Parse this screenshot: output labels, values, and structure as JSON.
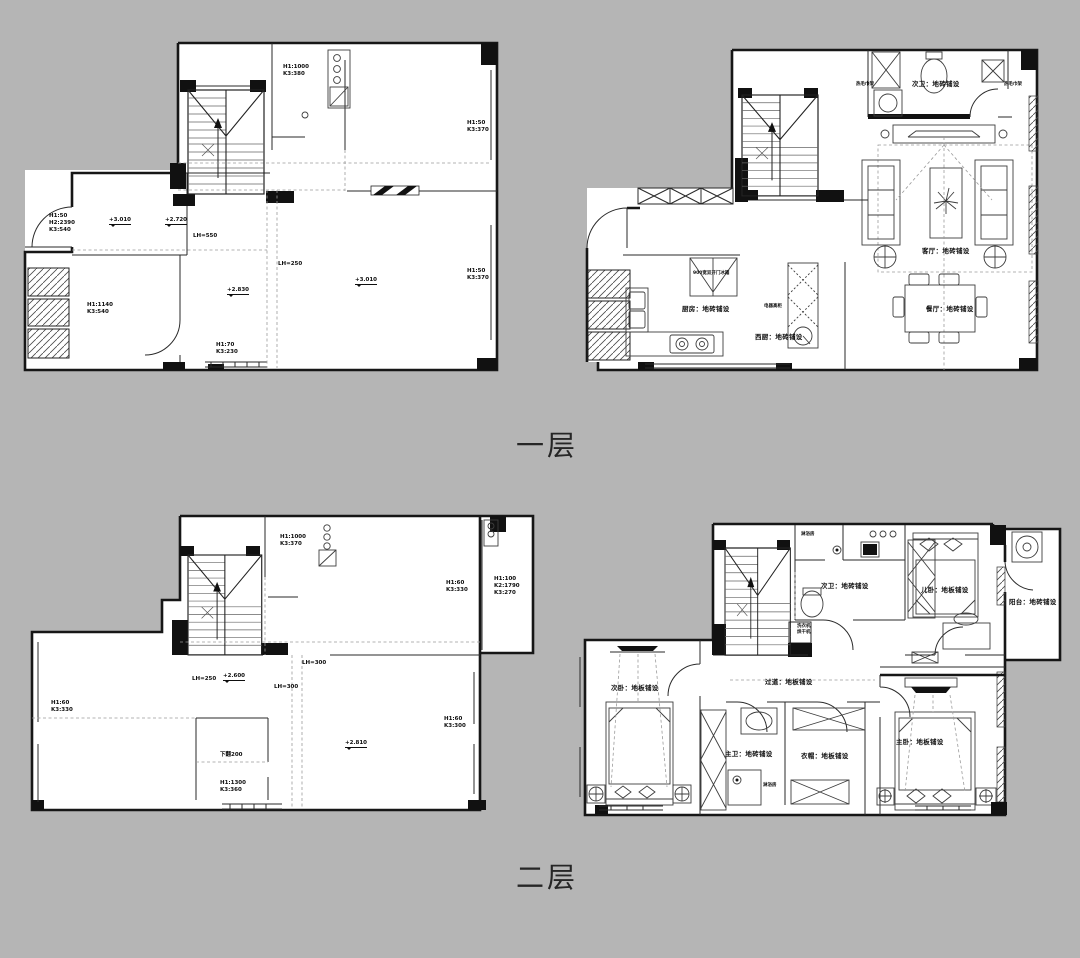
{
  "page": {
    "background": "#b5b5b5",
    "line_color": "#161616",
    "paper_color": "#ffffff"
  },
  "captions": {
    "floor1": "一层",
    "floor2": "二层"
  },
  "floor1_structural": {
    "annotations": [
      {
        "text": "H1:1000\nK3:380",
        "x": 268,
        "y": 54,
        "cls": "dim"
      },
      {
        "text": "H1:50\nK3:370",
        "x": 452,
        "y": 110,
        "cls": "dim"
      },
      {
        "text": "+3.010",
        "x": 94,
        "y": 207,
        "cls": "elev"
      },
      {
        "text": "+2.720",
        "x": 150,
        "y": 207,
        "cls": "elev"
      },
      {
        "text": "LH=550",
        "x": 178,
        "y": 223,
        "cls": "dim"
      },
      {
        "text": "H1:50\nH2:2390\nK3:540",
        "x": 34,
        "y": 203,
        "cls": "dim"
      },
      {
        "text": "LH=250",
        "x": 263,
        "y": 251,
        "cls": "dim"
      },
      {
        "text": "+3.010",
        "x": 340,
        "y": 267,
        "cls": "elev"
      },
      {
        "text": "H1:50\nK3:370",
        "x": 452,
        "y": 258,
        "cls": "dim"
      },
      {
        "text": "+2.830",
        "x": 212,
        "y": 277,
        "cls": "elev"
      },
      {
        "text": "H1:1140\nK3:540",
        "x": 72,
        "y": 292,
        "cls": "dim"
      },
      {
        "text": "H1:70\nK3:230",
        "x": 201,
        "y": 332,
        "cls": "dim"
      }
    ]
  },
  "floor1_furnished": {
    "annotations": [
      {
        "text": "热毛巾架",
        "x": 278,
        "y": 44,
        "cls": "tiny"
      },
      {
        "text": "次卫：地砖铺设",
        "x": 334,
        "y": 42,
        "cls": "room"
      },
      {
        "text": "热毛巾架",
        "x": 426,
        "y": 44,
        "cls": "tiny"
      },
      {
        "text": "客厅：地砖铺设",
        "x": 344,
        "y": 209,
        "cls": "room"
      },
      {
        "text": "900宽双开门冰箱",
        "x": 115,
        "y": 233,
        "cls": "tiny"
      },
      {
        "text": "厨房：地砖铺设",
        "x": 104,
        "y": 267,
        "cls": "room"
      },
      {
        "text": "电器高柜",
        "x": 186,
        "y": 266,
        "cls": "tiny"
      },
      {
        "text": "餐厅：地砖铺设",
        "x": 348,
        "y": 267,
        "cls": "room"
      },
      {
        "text": "西厨：地砖铺设",
        "x": 177,
        "y": 295,
        "cls": "room"
      }
    ]
  },
  "floor2_structural": {
    "annotations": [
      {
        "text": "H1:1000\nK3:370",
        "x": 250,
        "y": 22,
        "cls": "dim"
      },
      {
        "text": "H1:60\nK3:330",
        "x": 416,
        "y": 68,
        "cls": "dim"
      },
      {
        "text": "H1:100\nK2:1790\nK3:270",
        "x": 464,
        "y": 64,
        "cls": "dim"
      },
      {
        "text": "LH=300",
        "x": 272,
        "y": 148,
        "cls": "dim"
      },
      {
        "text": "LH=250",
        "x": 162,
        "y": 164,
        "cls": "dim"
      },
      {
        "text": "+2.600",
        "x": 193,
        "y": 161,
        "cls": "elev"
      },
      {
        "text": "LH=300",
        "x": 244,
        "y": 172,
        "cls": "dim"
      },
      {
        "text": "H1:60\nK3:330",
        "x": 21,
        "y": 188,
        "cls": "dim"
      },
      {
        "text": "下翻200",
        "x": 190,
        "y": 240,
        "cls": "dim"
      },
      {
        "text": "+2.810",
        "x": 315,
        "y": 228,
        "cls": "elev"
      },
      {
        "text": "H1:60\nK3:300",
        "x": 414,
        "y": 204,
        "cls": "dim"
      },
      {
        "text": "H1:1300\nK3:360",
        "x": 190,
        "y": 268,
        "cls": "dim"
      }
    ]
  },
  "floor2_furnished": {
    "annotations": [
      {
        "text": "淋浴房",
        "x": 226,
        "y": 20,
        "cls": "tiny"
      },
      {
        "text": "次卫：地砖铺设",
        "x": 246,
        "y": 70,
        "cls": "room"
      },
      {
        "text": "儿卧：地板铺设",
        "x": 346,
        "y": 74,
        "cls": "room"
      },
      {
        "text": "阳台：地砖铺设",
        "x": 434,
        "y": 86,
        "cls": "room"
      },
      {
        "text": "洗衣机\n烘干机",
        "x": 222,
        "y": 112,
        "cls": "tiny"
      },
      {
        "text": "次卧：地板铺设",
        "x": 36,
        "y": 172,
        "cls": "room"
      },
      {
        "text": "过道：地板铺设",
        "x": 190,
        "y": 166,
        "cls": "room"
      },
      {
        "text": "主卧：地板铺设",
        "x": 321,
        "y": 226,
        "cls": "room"
      },
      {
        "text": "主卫：地砖铺设",
        "x": 150,
        "y": 238,
        "cls": "room"
      },
      {
        "text": "衣帽：地板铺设",
        "x": 226,
        "y": 240,
        "cls": "room"
      },
      {
        "text": "淋浴房",
        "x": 188,
        "y": 271,
        "cls": "tiny"
      }
    ]
  }
}
